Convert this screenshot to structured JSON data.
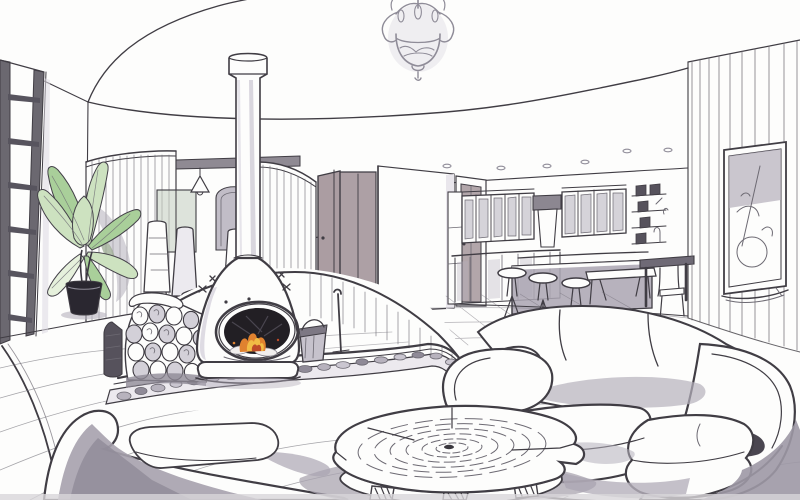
{
  "meta": {
    "kind": "hand-drawn interior design perspective sketch",
    "subject": "open-plan living room with suspended wood-burning stove, kitchen, dining nook and sofas",
    "width_px": 800,
    "height_px": 500,
    "visible_text": ""
  },
  "palette": {
    "paper": "#fdfdfc",
    "ink": "#403d44",
    "ink-soft": "#6d6a73",
    "pencil": "#8f8c98",
    "marker": "#b5b0bc",
    "marker-light": "#d8d5de",
    "marker-dark": "#938e9c",
    "shadow-dark": "#837e8c",
    "leaf": "#cde2c0",
    "leaf-mid": "#a9cf9a",
    "leaf-pale": "#e6f1dc",
    "leaf-shadow": "#9fae96",
    "flame-orange": "#e0822f",
    "flame-red": "#bf4b28",
    "flame-yellow": "#f1bc45",
    "door-mauve": "#a4969b",
    "door-dark": "#8e8086",
    "soot": "#221f24",
    "stone": "#b7b2bd",
    "scan-edge": "#d8d6da"
  },
  "scene": {
    "objects": [
      {
        "name": "ceiling-cove",
        "description": "large elliptical recessed ceiling sweeping across the top"
      },
      {
        "name": "ceiling-spotlights",
        "description": "row of small recessed spots over the kitchen"
      },
      {
        "name": "chandelier",
        "description": "ornate pencil-sketched pendant light hanging top centre"
      },
      {
        "name": "flue-pipe",
        "description": "white stove pipe rising from fireplace to ceiling collar"
      },
      {
        "name": "suspended-fireplace",
        "description": "teardrop wood stove, oval glass door, orange fire"
      },
      {
        "name": "firewood-stack",
        "description": "stacked log ends beside the stove"
      },
      {
        "name": "ash-bucket-and-poker",
        "description": "bucket and fire iron right of the stove"
      },
      {
        "name": "hearth-platform",
        "description": "curved raised timber hearth with pebble-stone edging"
      },
      {
        "name": "glazed-door",
        "description": "tall glazing bars window at far left"
      },
      {
        "name": "potted-plant",
        "description": "broad-leaf plant in a black pot"
      },
      {
        "name": "dining-nook",
        "description": "curved slatted screens, cone pendants, high-back chairs, table"
      },
      {
        "name": "interior-doors",
        "description": "open mauve-grey doors and white corner wall mid-frame"
      },
      {
        "name": "kitchen",
        "description": "wall cabinets, hood, island bar with stools, bench and table"
      },
      {
        "name": "wall-shelves",
        "description": "small framed pictures on shelves right of kitchen"
      },
      {
        "name": "feature-wall",
        "description": "vertical-slat curved wall on the right with framed artwork"
      },
      {
        "name": "white-sofa",
        "description": "large white three-seat sofa, right foreground"
      },
      {
        "name": "rear-sofa",
        "description": "second white sofa seen from behind, bottom left"
      },
      {
        "name": "coffee-table",
        "description": "tree-trunk slice table with growth rings, centre front"
      },
      {
        "name": "floor",
        "description": "curved wood planks foreground, tiled floor by kitchen"
      }
    ]
  }
}
